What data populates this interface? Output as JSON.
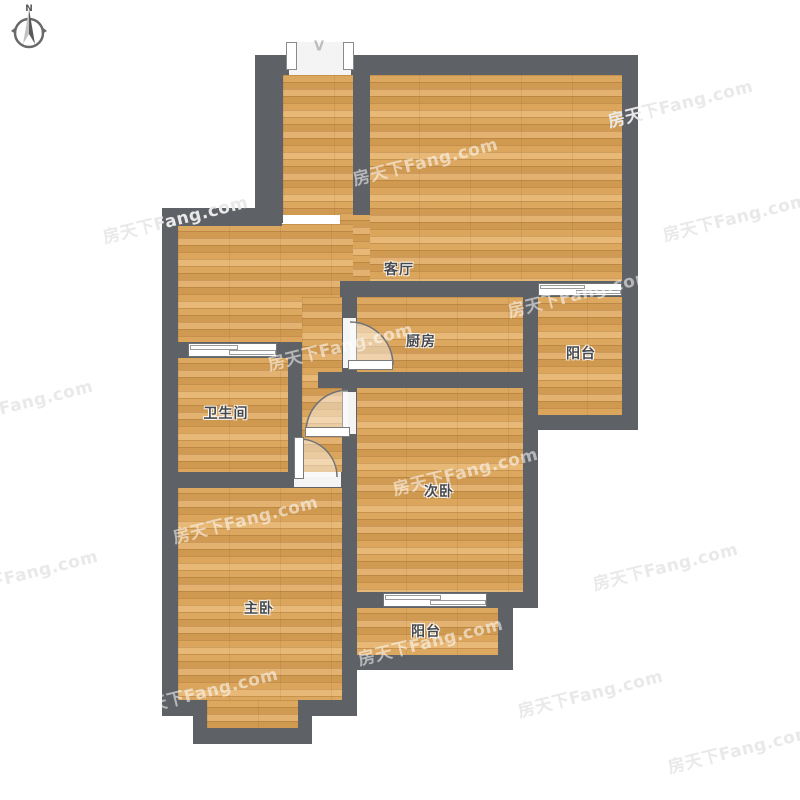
{
  "compass": {
    "north_label": "N"
  },
  "entry": {
    "door_symbol": "V"
  },
  "rooms": {
    "living_room": {
      "label": "客厅"
    },
    "kitchen": {
      "label": "厨房"
    },
    "balcony_right": {
      "label": "阳台"
    },
    "bathroom": {
      "label": "卫生间"
    },
    "second_bedroom": {
      "label": "次卧"
    },
    "master_bedroom": {
      "label": "主卧"
    },
    "balcony_bottom": {
      "label": "阳台"
    }
  },
  "watermark": {
    "text": "房天下Fang.com"
  },
  "colors": {
    "wall": "#5e6165",
    "floor_base": "#d8a55e",
    "watermark_on_white": "#e9e9e9",
    "watermark_on_wood": "rgba(255,255,255,0.55)"
  }
}
